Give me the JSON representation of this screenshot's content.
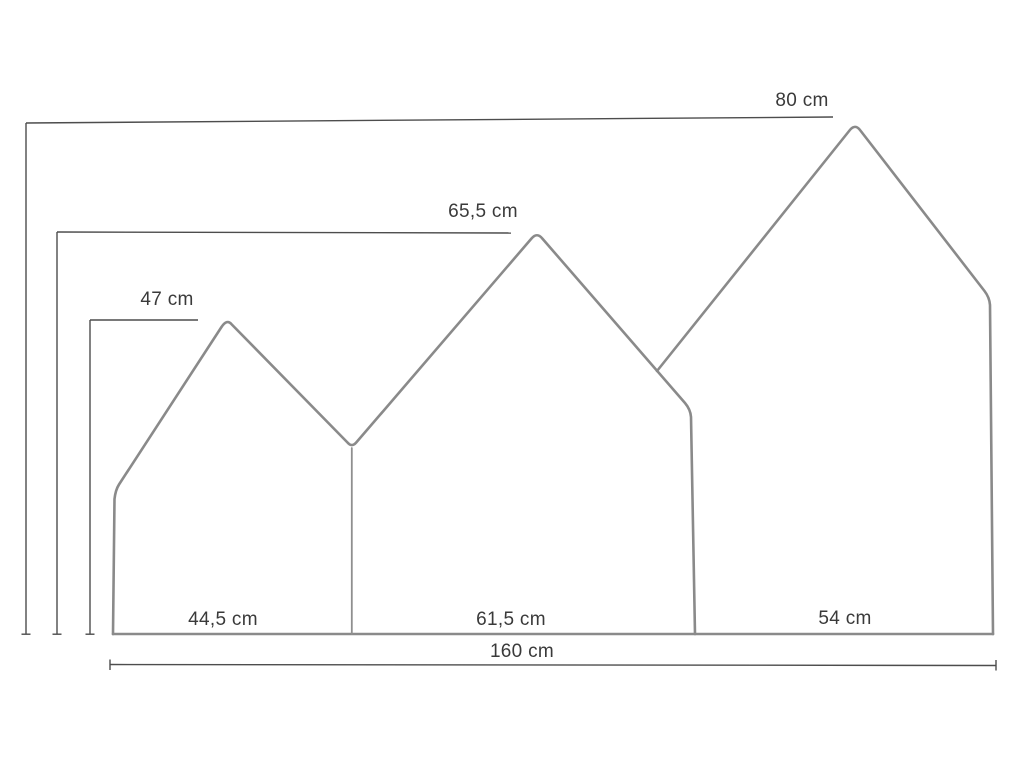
{
  "diagram": {
    "measurements": {
      "height_large": "80 cm",
      "height_medium": "65,5 cm",
      "height_small": "47 cm",
      "width_small": "44,5 cm",
      "width_medium": "61,5 cm",
      "width_large": "54 cm",
      "total_width": "160 cm"
    },
    "colors": {
      "background": "#ffffff",
      "panel_outline": "#8a8a8a",
      "dimension_line": "#4d4d4d",
      "label_text": "#3a3a3a"
    }
  }
}
